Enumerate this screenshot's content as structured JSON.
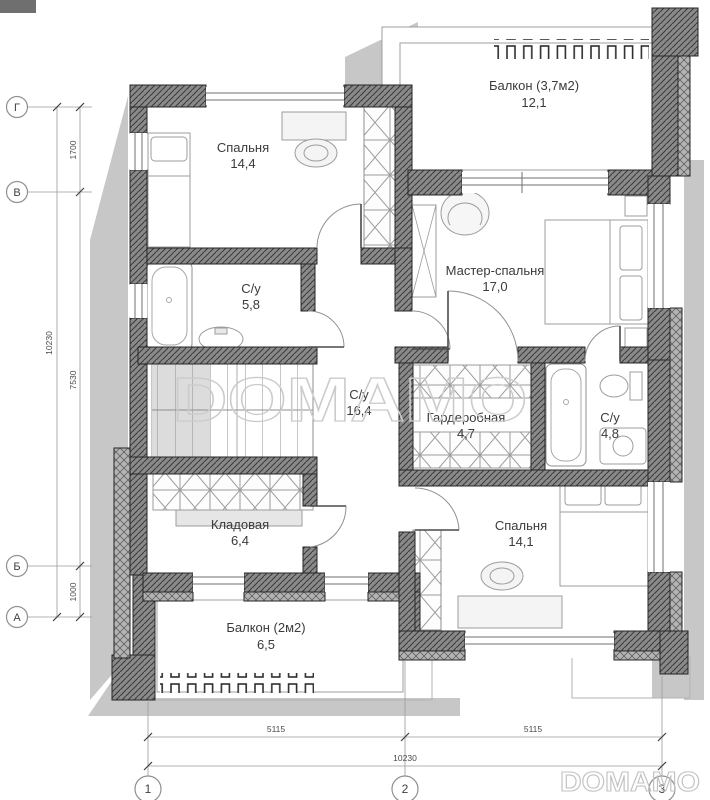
{
  "watermark": {
    "text": "DOMAMO"
  },
  "rooms": {
    "bedroom_top": {
      "name": "Спальня",
      "area": "14,4"
    },
    "balcony_top": {
      "name": "Балкон (3,7м2)",
      "area": "12,1"
    },
    "master_bedroom": {
      "name": "Мастер-спальня",
      "area": "17,0"
    },
    "bathroom_top": {
      "name": "С/у",
      "area": "5,8"
    },
    "hall": {
      "name": "С/у",
      "area": "16,4"
    },
    "wardrobe": {
      "name": "Гардеробная",
      "area": "4,7"
    },
    "bathroom_right": {
      "name": "С/у",
      "area": "4,8"
    },
    "storage": {
      "name": "Кладовая",
      "area": "6,4"
    },
    "bedroom_bottom": {
      "name": "Спальня",
      "area": "14,1"
    },
    "balcony_bottom": {
      "name": "Балкон (2м2)",
      "area": "6,5"
    }
  },
  "axes": {
    "rows": [
      "Г",
      "В",
      "Б",
      "А"
    ],
    "cols": [
      "1",
      "2",
      "3"
    ]
  },
  "dimensions": {
    "left_total": "10230",
    "left_segments": [
      "1700",
      "7530",
      "1000"
    ],
    "bottom_segments": [
      "5115",
      "5115"
    ],
    "bottom_total": "10230"
  },
  "colors": {
    "wall": "#8a8a8a",
    "shadow": "#c7c7c7",
    "watermark": "#c9c9c9"
  }
}
